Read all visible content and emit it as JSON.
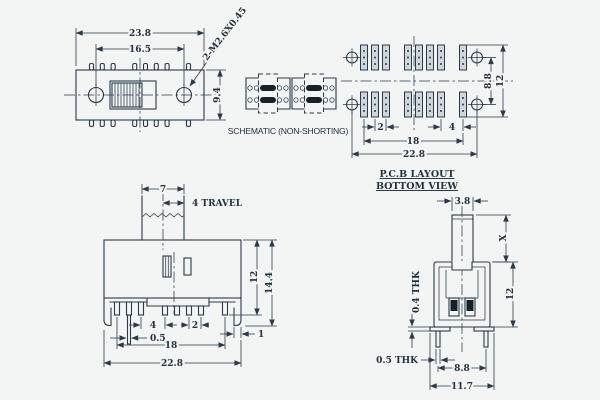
{
  "drawing": {
    "schematic": {
      "caption": "SCHEMATIC (NON-SHORTING)"
    },
    "top_view": {
      "dim_width": "23.8",
      "dim_hole_spacing": "16.5",
      "dim_height": "9.4",
      "thread_callout": "2-M2.6X0.45"
    },
    "pcb_view": {
      "title_line1": "P.C.B LAYOUT",
      "title_line2": "BOTTOM VIEW",
      "dim_pad_pitch": "2",
      "dim_end_gap": "4",
      "dim_pin_span": "18",
      "dim_width": "22.8",
      "dim_row_gap": "8.8",
      "dim_height": "12"
    },
    "front_view": {
      "dim_knob_width": "7",
      "dim_travel": "4 TRAVEL",
      "dim_pin_gap": "4",
      "dim_pin_pitch": "2",
      "dim_pin_width": "0.5",
      "dim_leg_width": "1",
      "dim_pin_span": "18",
      "dim_width": "22.8",
      "dim_body_height": "12",
      "dim_total_height": "14.4"
    },
    "side_view": {
      "dim_knob_width": "3.8",
      "dim_knob_height": "X",
      "dim_body_height": "12",
      "dim_foot_thickness": "0.4 THK",
      "dim_pin_thickness": "0.5 THK",
      "dim_pin_span": "8.8",
      "dim_width": "11.7"
    },
    "colors": {
      "line": "#2b3a4a",
      "background": "#f3f4f4",
      "contact_fill": "#16212c"
    }
  }
}
